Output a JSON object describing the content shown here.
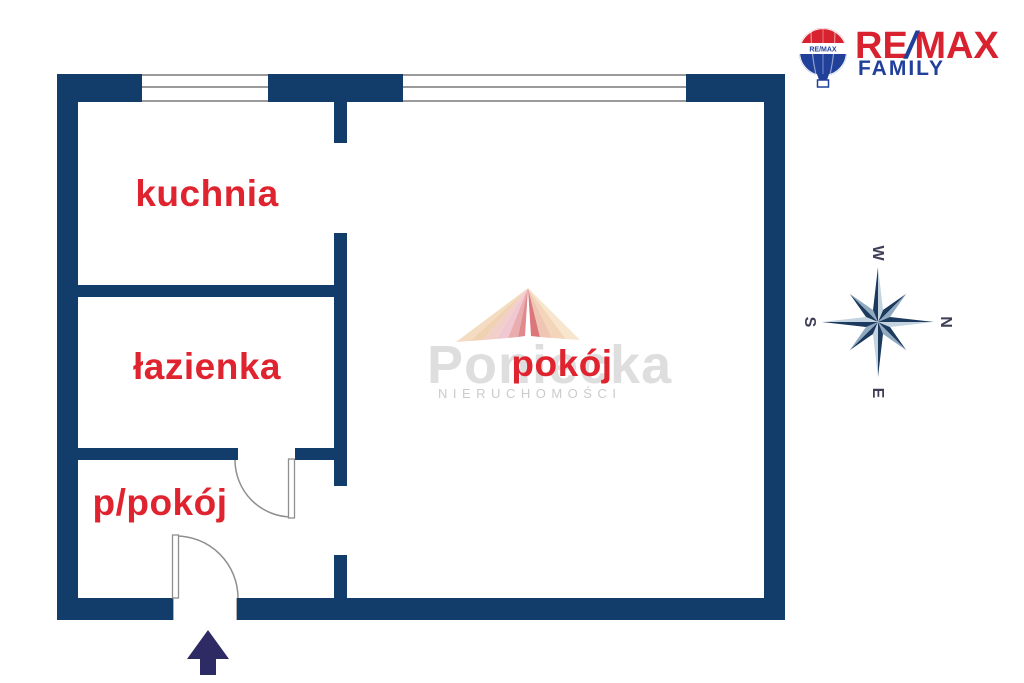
{
  "floorplan": {
    "rooms": [
      {
        "id": "kuchnia",
        "label": "kuchnia"
      },
      {
        "id": "lazienka",
        "label": "łazienka"
      },
      {
        "id": "p-pokoj",
        "label": "p/pokój"
      },
      {
        "id": "pokoj",
        "label": "pokój"
      }
    ],
    "colors": {
      "wall": "#123d6b",
      "room_label": "#e0242f",
      "entrance_arrow": "#2e2a63",
      "door_line": "#8f8f8f",
      "window_line": "#9a9a9a"
    }
  },
  "logo": {
    "brand_re": "RE",
    "brand_slash": "/",
    "brand_max": "MAX",
    "subtitle": "FAMILY",
    "balloon_text": "RE/MAX",
    "colors": {
      "red": "#d8222f",
      "blue": "#21409a"
    }
  },
  "compass": {
    "top": "W",
    "right": "N",
    "bottom": "E",
    "left": "S",
    "colors": {
      "dark": "#1c3a5e",
      "light": "#8fa9c0",
      "pale": "#c3d3e0",
      "letter": "#3e3e57"
    }
  },
  "watermark": {
    "name": "Poniecka",
    "subtitle": "NIERUCHOMOŚCI"
  }
}
